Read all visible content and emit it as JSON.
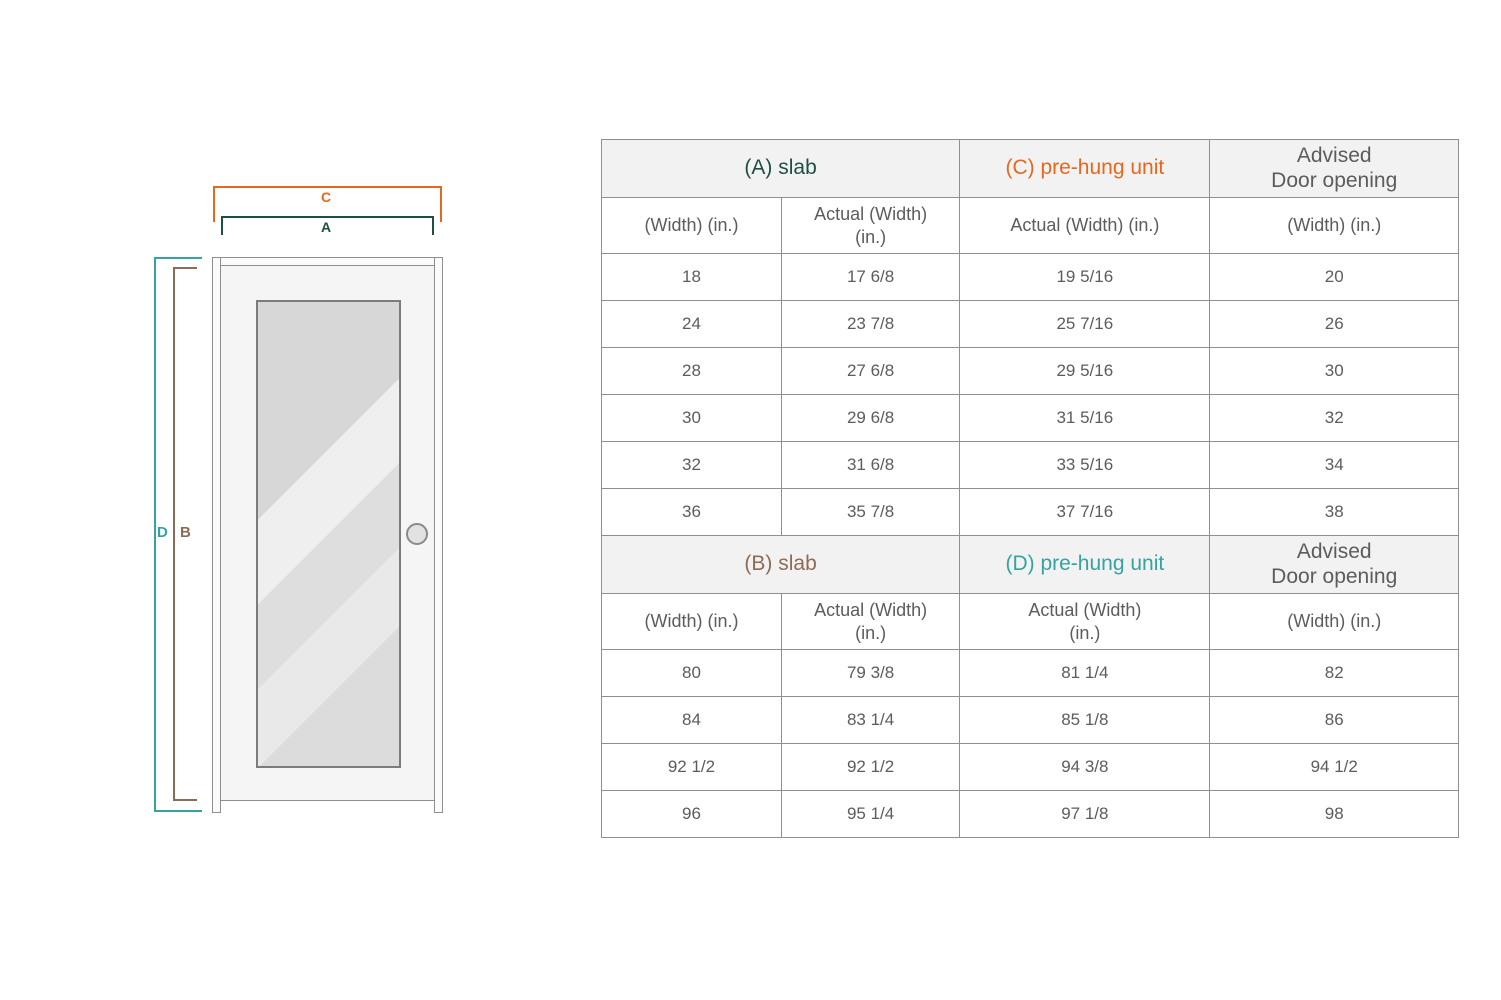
{
  "colors": {
    "a_dark_teal": "#1d4f46",
    "c_orange": "#e8671d",
    "d_teal": "#35a3a0",
    "b_brown": "#8d6c55",
    "table_text": "#5c5c5c",
    "table_border": "#8f8f8f",
    "header_bg": "#f2f2f2"
  },
  "diagram": {
    "labels": {
      "c": "C",
      "a": "A",
      "d": "D",
      "b": "B"
    }
  },
  "table": {
    "sections": [
      {
        "header": [
          {
            "lines": [
              "(A) slab"
            ],
            "color": "#1d4f46",
            "span": 2
          },
          {
            "lines": [
              "(C) pre-hung unit"
            ],
            "color": "#e8671d",
            "span": 1
          },
          {
            "lines": [
              "Advised",
              "Door opening"
            ],
            "color": "#5c5c5c",
            "span": 1
          }
        ],
        "subheader": [
          [
            "(Width) (in.)"
          ],
          [
            "Actual (Width)",
            "(in.)"
          ],
          [
            "Actual (Width) (in.)"
          ],
          [
            "(Width) (in.)"
          ]
        ],
        "rows": [
          [
            "18",
            "17 6/8",
            "19 5/16",
            "20"
          ],
          [
            "24",
            "23 7/8",
            "25 7/16",
            "26"
          ],
          [
            "28",
            "27 6/8",
            "29 5/16",
            "30"
          ],
          [
            "30",
            "29 6/8",
            "31 5/16",
            "32"
          ],
          [
            "32",
            "31 6/8",
            "33 5/16",
            "34"
          ],
          [
            "36",
            "35 7/8",
            "37 7/16",
            "38"
          ]
        ]
      },
      {
        "header": [
          {
            "lines": [
              "(B) slab"
            ],
            "color": "#8d6c55",
            "span": 2
          },
          {
            "lines": [
              "(D) pre-hung unit"
            ],
            "color": "#35a3a0",
            "span": 1
          },
          {
            "lines": [
              "Advised",
              "Door opening"
            ],
            "color": "#5c5c5c",
            "span": 1
          }
        ],
        "subheader": [
          [
            "(Width) (in.)"
          ],
          [
            "Actual (Width)",
            "(in.)"
          ],
          [
            "Actual (Width)",
            "(in.)"
          ],
          [
            "(Width) (in.)"
          ]
        ],
        "rows": [
          [
            "80",
            "79 3/8",
            "81 1/4",
            "82"
          ],
          [
            "84",
            "83 1/4",
            "85 1/8",
            "86"
          ],
          [
            "92 1/2",
            "92 1/2",
            "94 3/8",
            "94 1/2"
          ],
          [
            "96",
            "95 1/4",
            "97 1/8",
            "98"
          ]
        ]
      }
    ]
  }
}
